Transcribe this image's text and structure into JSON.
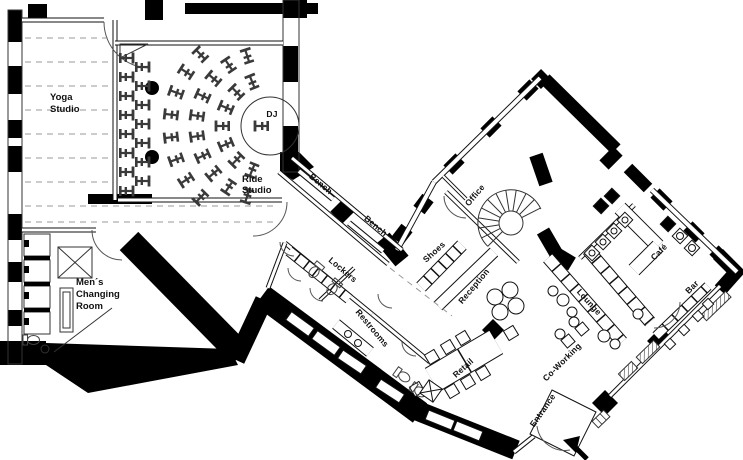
{
  "colors": {
    "walls": "#000000",
    "floor": "#ffffff",
    "lines": "#444444"
  },
  "rooms": {
    "yoga": {
      "line1": "Yoga",
      "line2": "Studio"
    },
    "ride": {
      "line1": "Ride",
      "line2": "Studio"
    },
    "dj": {
      "label": "DJ"
    },
    "mens_changing": {
      "line1": "Men´s",
      "line2": "Changing",
      "line3": "Room"
    },
    "bench_upper": {
      "label": "Bench"
    },
    "bench_lower": {
      "label": "Bench"
    },
    "lockers": {
      "label": "Lockers"
    },
    "restrooms": {
      "label": "Restrooms"
    },
    "shoes": {
      "label": "Shoes"
    },
    "office": {
      "label": "Office"
    },
    "reception": {
      "label": "Reception"
    },
    "retail": {
      "label": "Retail"
    },
    "coworking": {
      "label": "Co-Working"
    },
    "lounge": {
      "label": "Lounge"
    },
    "cafe": {
      "label": "Café"
    },
    "bar": {
      "label": "Bar"
    },
    "entrance": {
      "label": "Entrance"
    }
  }
}
